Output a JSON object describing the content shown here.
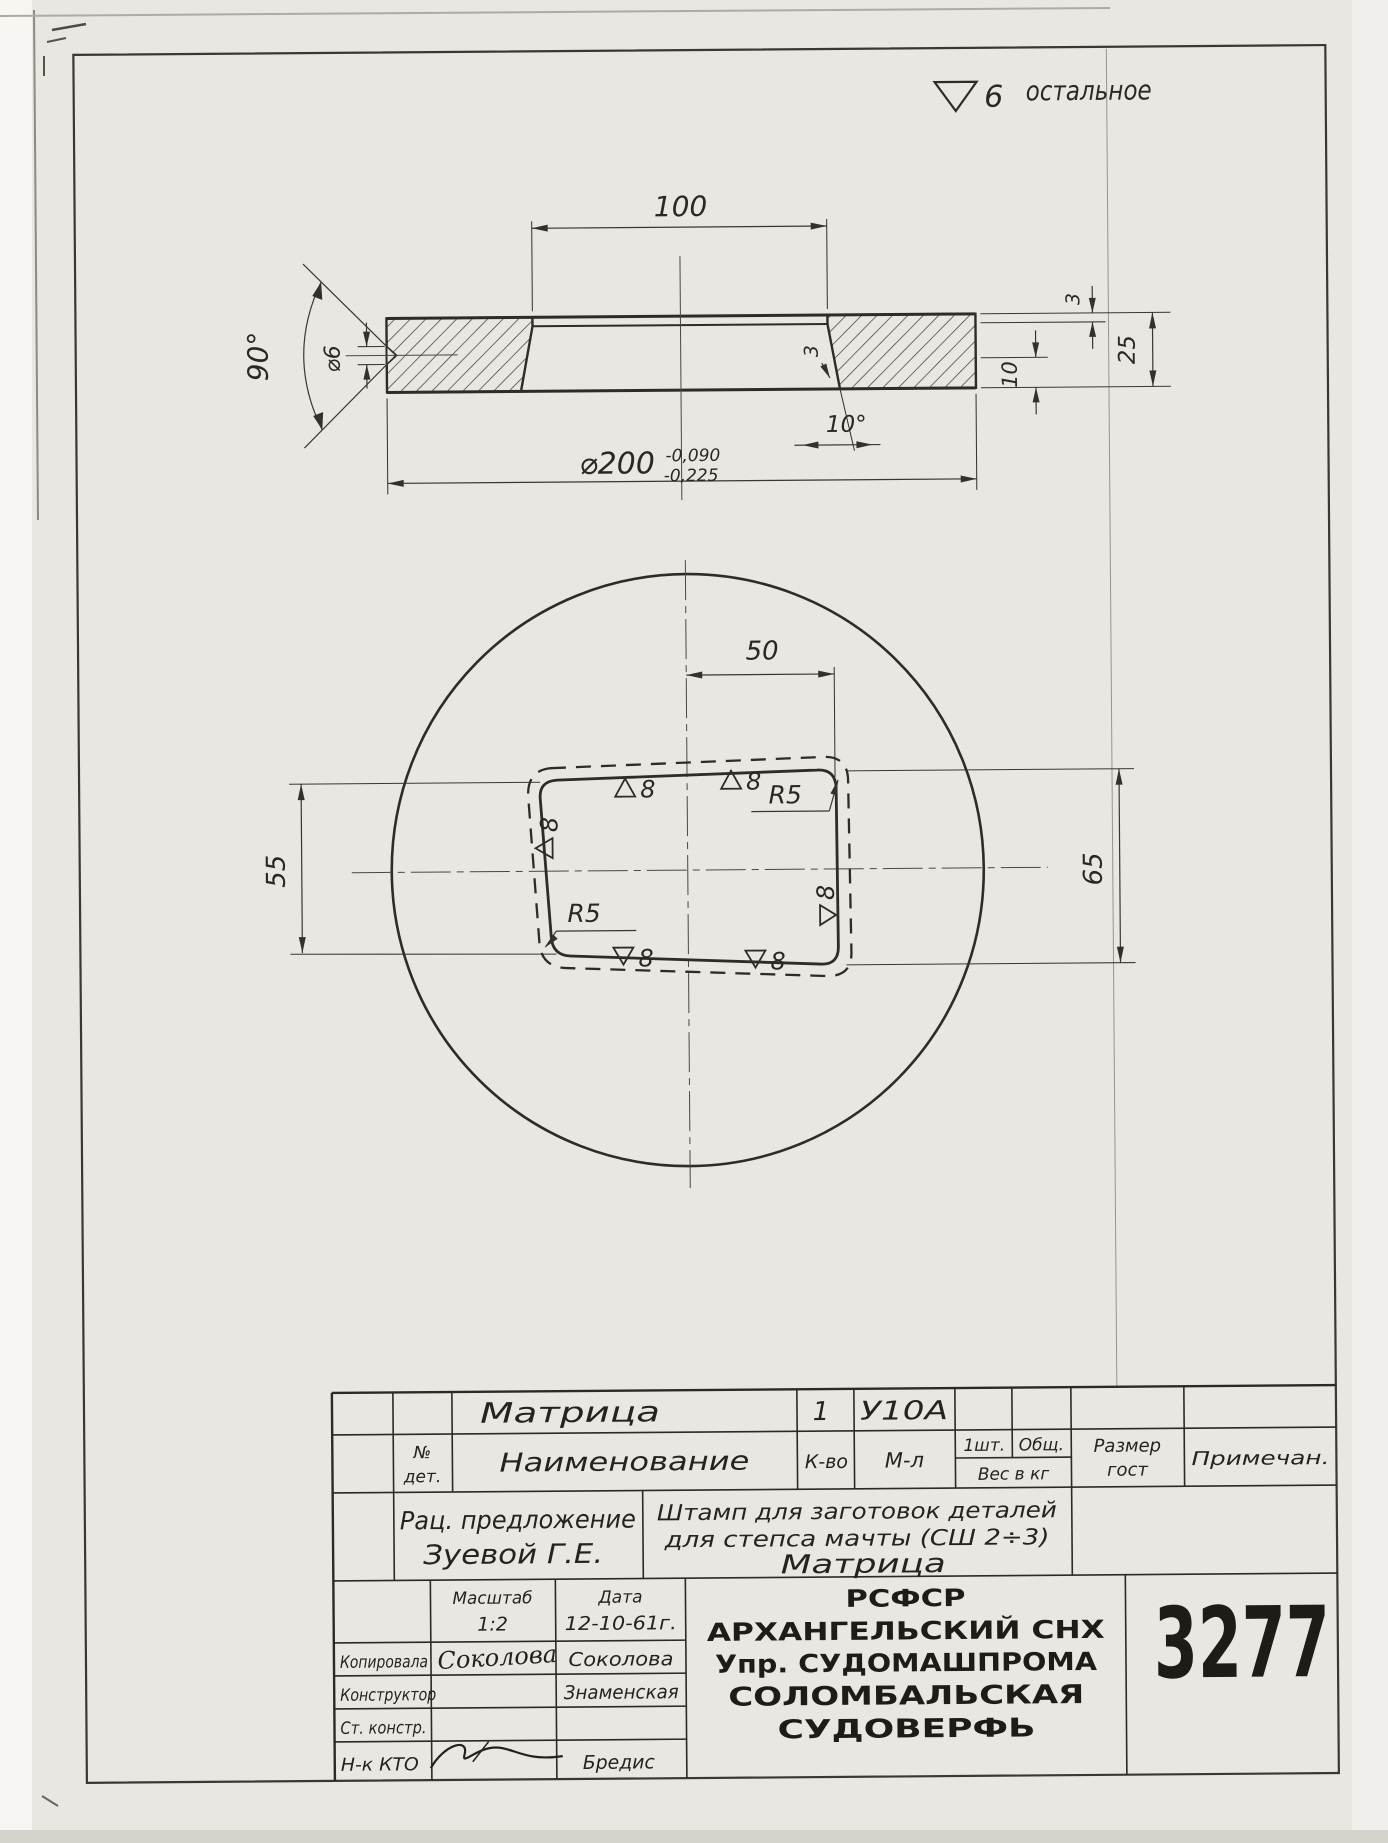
{
  "finish_note": {
    "grade": "6",
    "text": "остальное"
  },
  "section_view": {
    "dim_opening_width": "100",
    "dim_countersink_angle": "90°",
    "dim_countersink_dia": "⌀6",
    "dim_outer_dia": "⌀200",
    "tolerance_upper": "-0,090",
    "tolerance_lower": "-0,225",
    "dim_draft_angle": "10°",
    "dim_lip_depth_wall": "3",
    "dim_lip_depth_right": "3",
    "dim_land_height": "10",
    "dim_total_height": "25"
  },
  "plan_view": {
    "dim_half_width": "50",
    "dim_height_left": "55",
    "dim_height_right": "65",
    "radius_top": "R5",
    "radius_bottom": "R5",
    "marks": {
      "top1": "8",
      "top2": "8",
      "left": "8",
      "bottom1": "8",
      "bottom2": "8",
      "right": "8"
    }
  },
  "title_block": {
    "part_name": "Матрица",
    "qty_value": "1",
    "material_value": "У10А",
    "headers": {
      "no_det_1": "№",
      "no_det_2": "дет.",
      "name": "Наименование",
      "qty": "К-во",
      "material": "М-л",
      "per_item": "1шт.",
      "total": "Общ.",
      "weight": "Вес в кг",
      "size_1": "Размер",
      "size_2": "гост",
      "note": "Примечан."
    },
    "proposal_line1": "Рац. предложение",
    "proposal_line2": "Зуевой Г.Е.",
    "desc_line1": "Штамп для заготовок деталей",
    "desc_line2": "для степса мачты (СШ 2÷3)",
    "desc_line3": "Матрица",
    "scale_label": "Масштаб",
    "scale_value": "1:2",
    "date_label": "Дата",
    "date_value": "12-10-61г.",
    "rows": {
      "copied_label": "Копировала",
      "copied_signature": "Соколова",
      "copied_name": "Соколова",
      "designer_label": "Конструктор",
      "designer_name": "Знаменская",
      "senior_label": "Ст. констр.",
      "chief_label": "Н-к КТО",
      "chief_name": "Бредис"
    },
    "org_line1": "РСФСР",
    "org_line2": "АРХАНГЕЛЬСКИЙ СНХ",
    "org_line3": "Упр. СУДОМАШПРОМА",
    "org_line4": "СОЛОМБАЛЬСКАЯ",
    "org_line5": "СУДОВЕРФЬ",
    "doc_number": "3277"
  }
}
